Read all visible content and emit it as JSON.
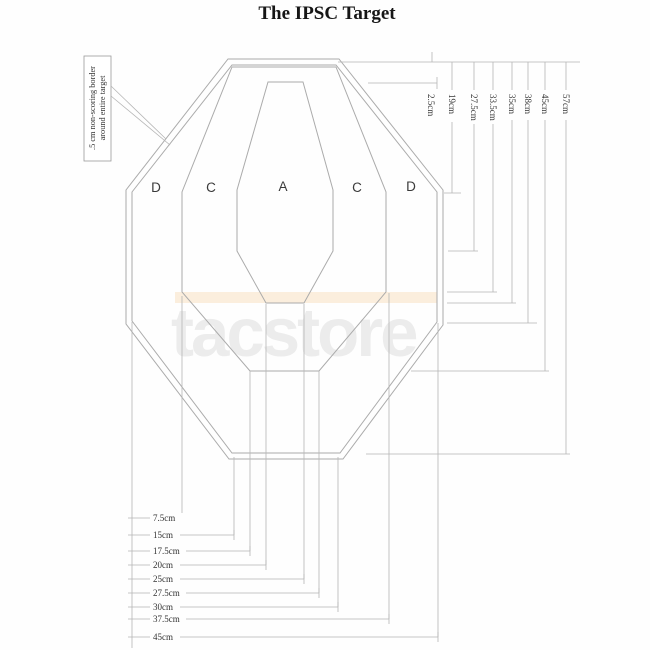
{
  "title": "The IPSC Target",
  "watermark": "tacstore",
  "border_label": {
    "line1": ".5 cm non-scoring border",
    "line2": "around entire target"
  },
  "zones": [
    "D",
    "C",
    "A",
    "C",
    "D"
  ],
  "dimensions": {
    "right": [
      {
        "label": "2.5cm"
      },
      {
        "label": "19cm"
      },
      {
        "label": "27.5cm"
      },
      {
        "label": "33.5cm"
      },
      {
        "label": "35cm"
      },
      {
        "label": "38cm"
      },
      {
        "label": "45cm"
      },
      {
        "label": "57cm"
      }
    ],
    "bottom": [
      {
        "label": "7.5cm"
      },
      {
        "label": "15cm"
      },
      {
        "label": "17.5cm"
      },
      {
        "label": "20cm"
      },
      {
        "label": "25cm"
      },
      {
        "label": "27.5cm"
      },
      {
        "label": "30cm"
      },
      {
        "label": "37.5cm"
      },
      {
        "label": "45cm"
      }
    ]
  },
  "colors": {
    "shape_line": "#ababab",
    "dimension_line": "#b5b5b5",
    "watermark_gray": "#ececec",
    "watermark_band": "#fbeedd",
    "text": "#333333"
  }
}
